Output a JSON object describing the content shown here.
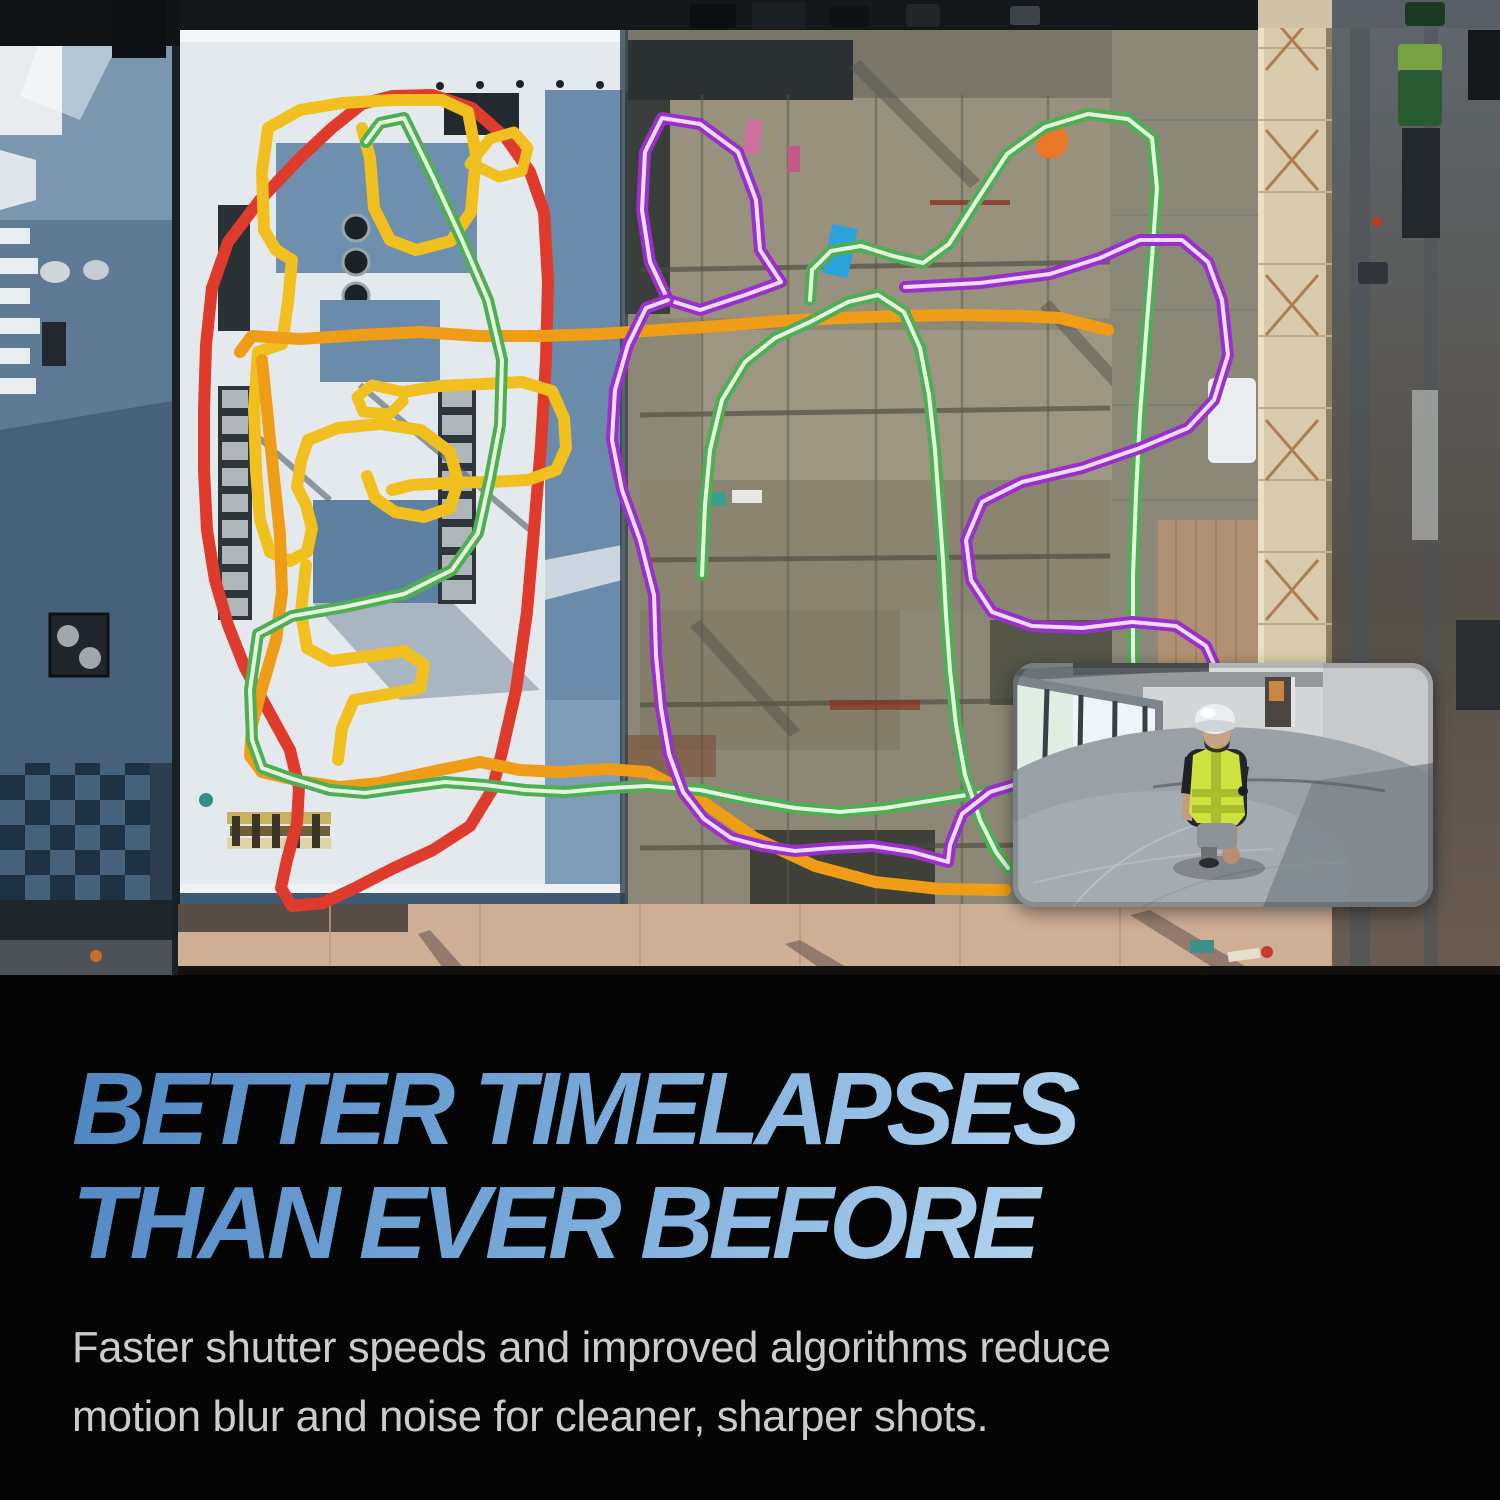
{
  "headline": {
    "line1": "BETTER TIMELAPSES",
    "line2": "THAN EVER BEFORE"
  },
  "subtext": {
    "line1": "Faster shutter speeds and improved algorithms reduce",
    "line2": "motion blur and noise for cleaner, sharper shots."
  },
  "colors": {
    "background": "#050505",
    "headline_gradient_start": "#4e85c2",
    "headline_gradient_end": "#dceffb",
    "subtext": "#cbcccd",
    "path_red": "#df3b2d",
    "path_yellow": "#f1c01f",
    "path_orange": "#ef9c17",
    "path_green": "#4fae54",
    "path_green_core": "#e4f4de",
    "path_purple": "#9a30ca",
    "path_purple_core": "#f0dcfa",
    "hardhat": "#e9edf1",
    "safety_vest": "#cde23f"
  },
  "paths": [
    {
      "name": "camera-path-red",
      "color": "#df3b2d",
      "width": 12,
      "points": "362,104 392,96 432,95 472,108 506,138 530,172 544,212 548,282 546,360 541,445 534,530 527,612 516,690 502,752 492,790 470,826 433,850 394,868 355,888 323,903 292,906 281,888 287,860 297,823 299,788 290,750 268,710 245,668 228,625 215,580 207,530 204,470 204,410 206,345 212,288 228,242 260,200 300,158 332,128 362,104"
    },
    {
      "name": "camera-path-yellow-1",
      "color": "#f1c01f",
      "width": 12,
      "points": "256,470 254,408 258,352 282,344 288,302 292,260 276,250 264,230 262,172 268,128 300,110 342,103 394,100 442,100 468,112 476,154 471,212 451,241 416,250 390,240 374,208 370,158 362,128"
    },
    {
      "name": "camera-path-yellow-2",
      "color": "#f1c01f",
      "width": 11,
      "points": "470,164 490,139 514,132 528,148 522,171 499,177 481,168"
    },
    {
      "name": "camera-path-yellow-3",
      "color": "#f1c01f",
      "width": 12,
      "points": "256,470 260,520 270,552 290,561 307,552 312,528 306,505 297,487 301,461 308,440 338,428 380,424 421,430 450,452 458,482 450,508 424,517 395,512 375,498 367,476"
    },
    {
      "name": "camera-path-yellow-4",
      "color": "#f1c01f",
      "width": 12,
      "points": "404,392 440,386 482,384 522,382 552,391 564,418 566,448 556,470 528,480 488,482 448,483 412,485 392,490"
    },
    {
      "name": "camera-path-yellow-5",
      "color": "#f1c01f",
      "width": 11,
      "points": "404,392 372,385 357,397 363,412 390,414 403,401"
    },
    {
      "name": "camera-path-yellow-6",
      "color": "#f1c01f",
      "width": 12,
      "points": "306,565 301,612 307,648 331,661 369,656 404,651 424,665 420,688 389,694 354,700 342,728 338,760"
    },
    {
      "name": "camera-path-orange-1",
      "color": "#ef9c17",
      "width": 12,
      "points": "240,352 252,336 300,339 360,335 420,332 480,336 540,336 600,334 660,330 720,326 780,321 840,318 900,316 960,315 1020,316 1060,318 1108,330"
    },
    {
      "name": "camera-path-orange-2",
      "color": "#ef9c17",
      "width": 12,
      "points": "262,360 268,420 274,478 280,535 282,592 276,640 262,688 252,725 250,756 262,772 300,781 340,787 380,783 440,770 480,762 520,770 560,772 607,769 648,772 700,800 755,838 815,866 875,882 940,889 1005,890"
    },
    {
      "name": "camera-path-green-1",
      "color": "#4fae54",
      "width": 12,
      "core": "#e4f4de",
      "core_width": 4,
      "points": "366,142 380,123 404,118 432,175 462,240 488,300 502,360 500,425 490,478 478,533 452,570 404,594 344,607 292,616 258,634 250,690 252,740 262,768 290,778 330,790 365,793 400,788 445,782 485,785 525,790 565,792 610,788 648,786 700,790 748,800 795,808 840,812 885,808 935,800 985,792 1038,783 1090,774 1126,760 1136,728 1133,655 1133,575 1136,495 1140,415 1146,335 1152,258 1157,188 1152,138 1128,119 1088,114 1045,127 1007,154 977,200 949,244 923,263 893,256 861,246 831,251 812,270 810,300"
    },
    {
      "name": "camera-path-green-2",
      "color": "#4fae54",
      "width": 12,
      "core": "#e4f4de",
      "core_width": 4,
      "points": "702,575 705,505 710,450 722,400 745,362 775,338 810,322 848,302 878,295 904,312 920,348 929,395 935,450 939,505 943,560 946,615 950,670 956,725 965,775 980,820 996,852 1008,868"
    },
    {
      "name": "camera-path-purple-1",
      "color": "#9a30ca",
      "width": 12,
      "core": "#f0dcfa",
      "core_width": 4,
      "points": "781,282 760,250 756,200 738,152 700,124 662,118 645,152 642,210 650,262 668,300 700,310 745,295 781,282"
    },
    {
      "name": "camera-path-purple-2",
      "color": "#9a30ca",
      "width": 12,
      "core": "#f0dcfa",
      "core_width": 4,
      "points": "905,287 980,283 1050,274 1100,258 1140,240 1182,240 1208,262 1222,300 1228,355 1214,400 1188,428 1140,448 1082,468 1022,482 982,502 966,540 971,580 992,612 1032,626 1082,628 1132,622 1176,626 1206,646 1222,682 1224,722 1208,756 1174,772 1128,778 1080,776 1030,780 990,792 962,814 950,845 948,862 912,852 872,846 832,848 795,851 762,846 731,838 704,819 683,792 669,754 661,708 656,655 654,595 640,540 622,490 612,440 615,390 628,345 646,308 668,300"
    }
  ]
}
